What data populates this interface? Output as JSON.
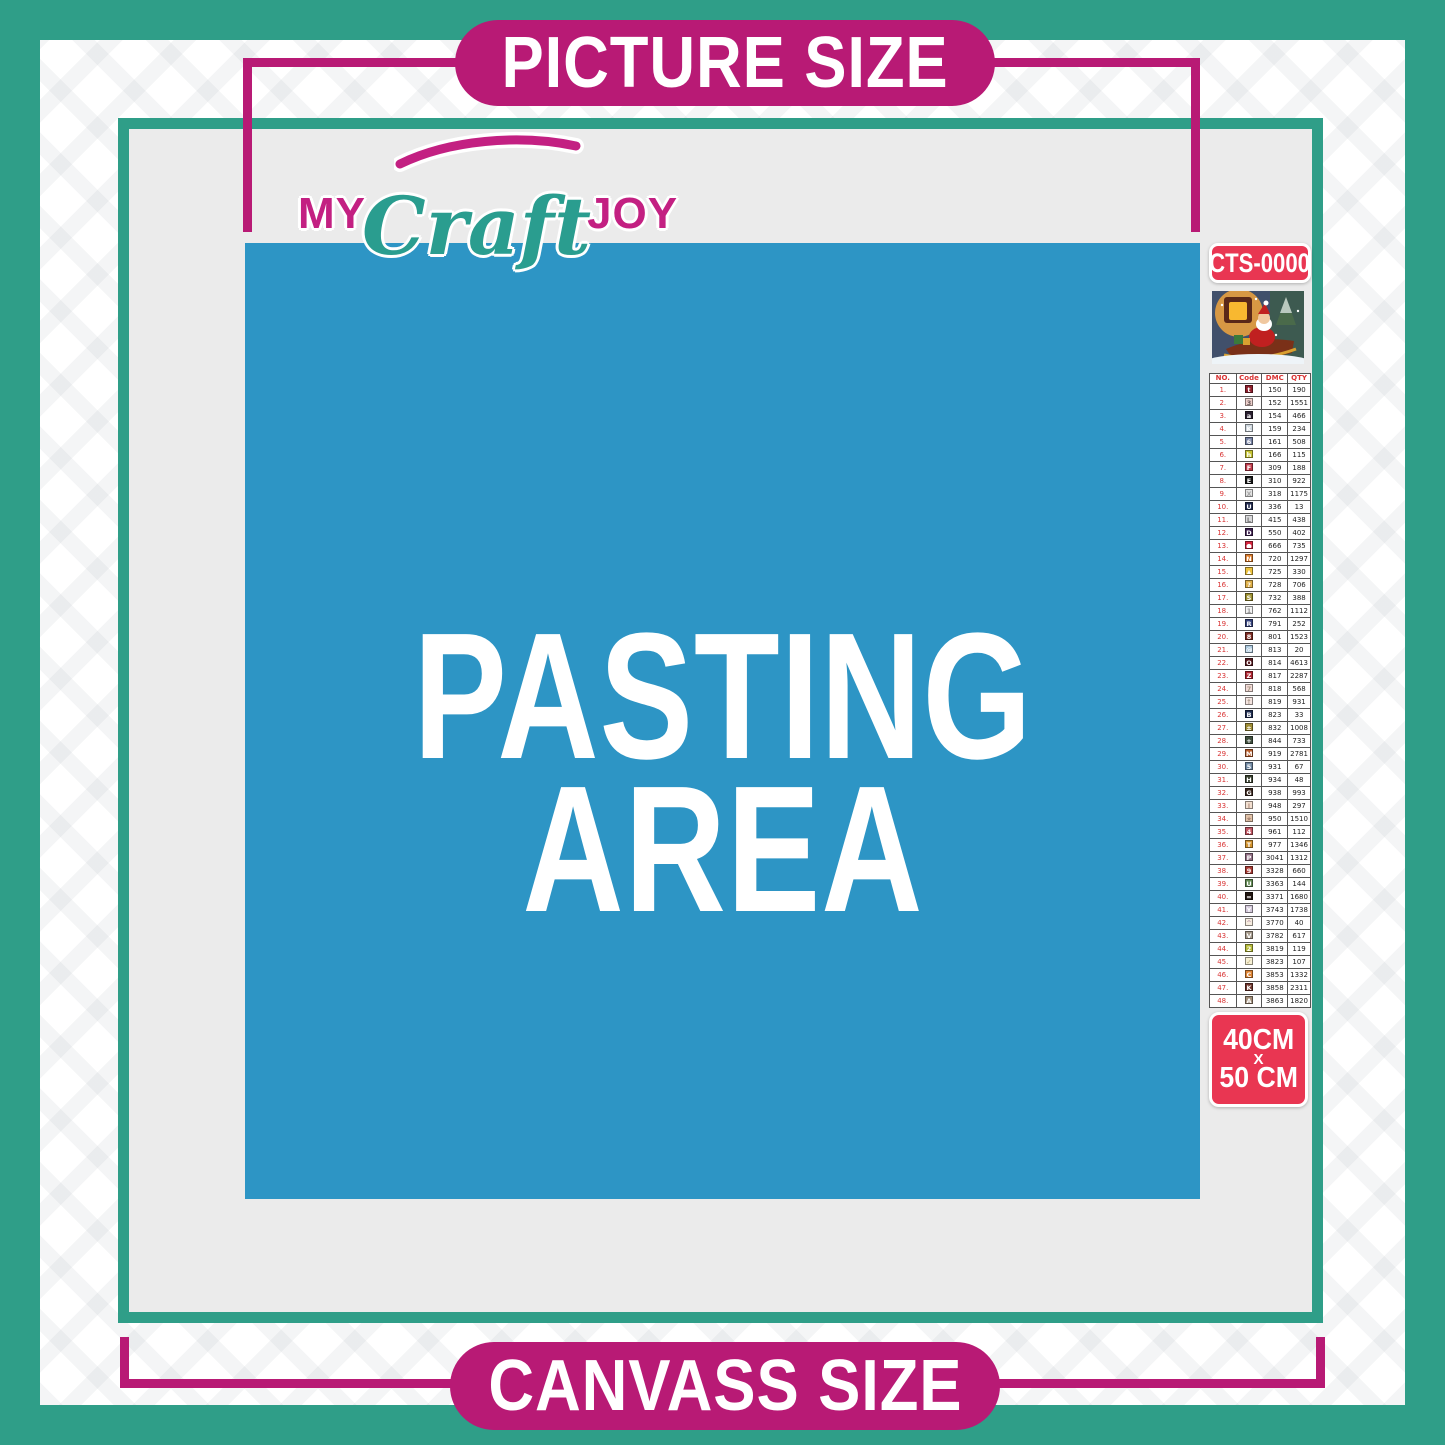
{
  "colors": {
    "teal": "#2f9e88",
    "magenta": "#b81a75",
    "blue": "#2d95c5",
    "badge_red": "#e93652",
    "panel_gray": "#ebebeb",
    "logo_magenta": "#c32082",
    "logo_teal": "#2a9d8f"
  },
  "banners": {
    "top": "PICTURE SIZE",
    "bottom": "CANVASS SIZE"
  },
  "logo": {
    "part1": "MY",
    "part2": "Craft",
    "part3": "JOY"
  },
  "pasting_area": {
    "line1": "PASTING",
    "line2": "AREA"
  },
  "product": {
    "code": "CTS-0000",
    "thumbnail": "santa-sleigh-christmas-scene"
  },
  "size_badge": {
    "line1": "40CM",
    "line2": "X",
    "line3": "50 CM"
  },
  "legend": {
    "headers": [
      "NO.",
      "Code",
      "DMC",
      "QTY"
    ],
    "rows": [
      {
        "no": "1.",
        "sym": "t",
        "bg": "#8f1f2c",
        "fg": "#ffffff",
        "dmc": "150",
        "qty": "190"
      },
      {
        "no": "2.",
        "sym": "3",
        "bg": "#edd0cc",
        "fg": "#6b5b5b",
        "dmc": "152",
        "qty": "1551"
      },
      {
        "no": "3.",
        "sym": "a",
        "bg": "#2a1f30",
        "fg": "#ffffff",
        "dmc": "154",
        "qty": "466"
      },
      {
        "no": "4.",
        "sym": "K",
        "bg": "#ccd5dd",
        "fg": "#ffffff",
        "dmc": "159",
        "qty": "234"
      },
      {
        "no": "5.",
        "sym": "6",
        "bg": "#7681a3",
        "fg": "#ffffff",
        "dmc": "161",
        "qty": "508"
      },
      {
        "no": "6.",
        "sym": "h",
        "bg": "#c6c433",
        "fg": "#ffffff",
        "dmc": "166",
        "qty": "115"
      },
      {
        "no": "7.",
        "sym": "F",
        "bg": "#c13a4a",
        "fg": "#ffffff",
        "dmc": "309",
        "qty": "188"
      },
      {
        "no": "8.",
        "sym": "E",
        "bg": "#151515",
        "fg": "#ffffff",
        "dmc": "310",
        "qty": "922"
      },
      {
        "no": "9.",
        "sym": "X",
        "bg": "#e4e4e4",
        "fg": "#a8a8a8",
        "dmc": "318",
        "qty": "1175"
      },
      {
        "no": "10.",
        "sym": "U",
        "bg": "#20294e",
        "fg": "#ffffff",
        "dmc": "336",
        "qty": "13"
      },
      {
        "no": "11.",
        "sym": "L",
        "bg": "#d9d9db",
        "fg": "#808080",
        "dmc": "415",
        "qty": "438"
      },
      {
        "no": "12.",
        "sym": "D",
        "bg": "#3f2050",
        "fg": "#ffffff",
        "dmc": "550",
        "qty": "402"
      },
      {
        "no": "13.",
        "sym": "●",
        "bg": "#d8253e",
        "fg": "#ffffff",
        "dmc": "666",
        "qty": "735"
      },
      {
        "no": "14.",
        "sym": "N",
        "bg": "#dd7b2a",
        "fg": "#ffffff",
        "dmc": "720",
        "qty": "1297"
      },
      {
        "no": "15.",
        "sym": "▲",
        "bg": "#eec33e",
        "fg": "#ffffff",
        "dmc": "725",
        "qty": "330"
      },
      {
        "no": "16.",
        "sym": "?",
        "bg": "#dfaf47",
        "fg": "#ffffff",
        "dmc": "728",
        "qty": "706"
      },
      {
        "no": "17.",
        "sym": "S",
        "bg": "#9c8f2e",
        "fg": "#ffffff",
        "dmc": "732",
        "qty": "388"
      },
      {
        "no": "18.",
        "sym": "1",
        "bg": "#f2f2f2",
        "fg": "#999999",
        "dmc": "762",
        "qty": "1112"
      },
      {
        "no": "19.",
        "sym": "R",
        "bg": "#35427d",
        "fg": "#ffffff",
        "dmc": "791",
        "qty": "252"
      },
      {
        "no": "20.",
        "sym": "8",
        "bg": "#7d2a22",
        "fg": "#ffffff",
        "dmc": "801",
        "qty": "1523"
      },
      {
        "no": "21.",
        "sym": "@",
        "bg": "#aac8de",
        "fg": "#ffffff",
        "dmc": "813",
        "qty": "20"
      },
      {
        "no": "22.",
        "sym": "O",
        "bg": "#571a20",
        "fg": "#ffffff",
        "dmc": "814",
        "qty": "4613"
      },
      {
        "no": "23.",
        "sym": "Z",
        "bg": "#b02430",
        "fg": "#ffffff",
        "dmc": "817",
        "qty": "2287"
      },
      {
        "no": "24.",
        "sym": "7",
        "bg": "#f3dcd8",
        "fg": "#aa9988",
        "dmc": "818",
        "qty": "568"
      },
      {
        "no": "25.",
        "sym": "↑",
        "bg": "#f4e4e0",
        "fg": "#aa9988",
        "dmc": "819",
        "qty": "931"
      },
      {
        "no": "26.",
        "sym": "B",
        "bg": "#1e2c50",
        "fg": "#ffffff",
        "dmc": "823",
        "qty": "33"
      },
      {
        "no": "27.",
        "sym": "±",
        "bg": "#9f8d35",
        "fg": "#ffffff",
        "dmc": "832",
        "qty": "1008"
      },
      {
        "no": "28.",
        "sym": "+",
        "bg": "#41503f",
        "fg": "#ffffff",
        "dmc": "844",
        "qty": "733"
      },
      {
        "no": "29.",
        "sym": "M",
        "bg": "#b85c2a",
        "fg": "#ffffff",
        "dmc": "919",
        "qty": "2781"
      },
      {
        "no": "30.",
        "sym": "5",
        "bg": "#6d86a0",
        "fg": "#ffffff",
        "dmc": "931",
        "qty": "67"
      },
      {
        "no": "31.",
        "sym": "H",
        "bg": "#39412f",
        "fg": "#ffffff",
        "dmc": "934",
        "qty": "48"
      },
      {
        "no": "32.",
        "sym": "G",
        "bg": "#39261d",
        "fg": "#ffffff",
        "dmc": "938",
        "qty": "993"
      },
      {
        "no": "33.",
        "sym": "J",
        "bg": "#f2dfd0",
        "fg": "#bb9988",
        "dmc": "948",
        "qty": "297"
      },
      {
        "no": "34.",
        "sym": "★",
        "bg": "#e2c3a9",
        "fg": "#aa8877",
        "dmc": "950",
        "qty": "1510"
      },
      {
        "no": "35.",
        "sym": "4",
        "bg": "#c25663",
        "fg": "#ffffff",
        "dmc": "961",
        "qty": "112"
      },
      {
        "no": "36.",
        "sym": "T",
        "bg": "#d4942f",
        "fg": "#ffffff",
        "dmc": "977",
        "qty": "1346"
      },
      {
        "no": "37.",
        "sym": "P",
        "bg": "#937085",
        "fg": "#ffffff",
        "dmc": "3041",
        "qty": "1312"
      },
      {
        "no": "38.",
        "sym": "9",
        "bg": "#a93b34",
        "fg": "#ffffff",
        "dmc": "3328",
        "qty": "660"
      },
      {
        "no": "39.",
        "sym": "U",
        "bg": "#628a54",
        "fg": "#ffffff",
        "dmc": "3363",
        "qty": "144"
      },
      {
        "no": "40.",
        "sym": "=",
        "bg": "#201510",
        "fg": "#ffffff",
        "dmc": "3371",
        "qty": "1680"
      },
      {
        "no": "41.",
        "sym": "Y",
        "bg": "#d3c8da",
        "fg": "#ffffff",
        "dmc": "3743",
        "qty": "1738"
      },
      {
        "no": "42.",
        "sym": "^",
        "bg": "#f6ecdf",
        "fg": "#bb99aa",
        "dmc": "3770",
        "qty": "40"
      },
      {
        "no": "43.",
        "sym": "V",
        "bg": "#a69a8b",
        "fg": "#ffffff",
        "dmc": "3782",
        "qty": "617"
      },
      {
        "no": "44.",
        "sym": "2",
        "bg": "#b7bc3a",
        "fg": "#ffffff",
        "dmc": "3819",
        "qty": "119"
      },
      {
        "no": "45.",
        "sym": "✓",
        "bg": "#f7f0d4",
        "fg": "#bbaa77",
        "dmc": "3823",
        "qty": "107"
      },
      {
        "no": "46.",
        "sym": "C",
        "bg": "#df8433",
        "fg": "#ffffff",
        "dmc": "3853",
        "qty": "1332"
      },
      {
        "no": "47.",
        "sym": "K",
        "bg": "#6e342b",
        "fg": "#ffffff",
        "dmc": "3858",
        "qty": "2311"
      },
      {
        "no": "48.",
        "sym": "A",
        "bg": "#a28f7a",
        "fg": "#ffffff",
        "dmc": "3863",
        "qty": "1820"
      }
    ]
  }
}
